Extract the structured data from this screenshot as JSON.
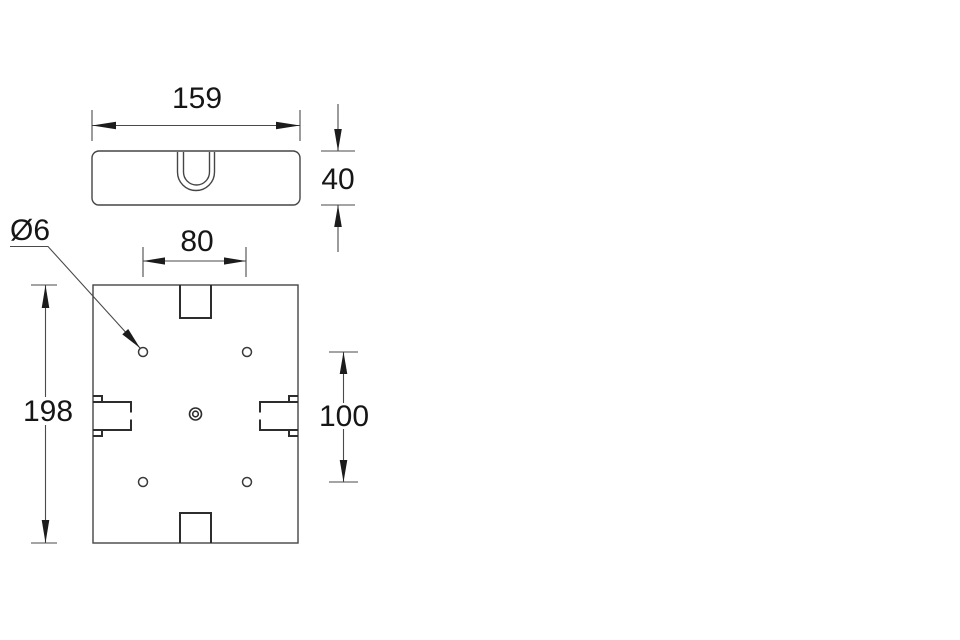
{
  "drawing": {
    "type": "technical-dimension-drawing",
    "background": "#ffffff",
    "line_color": "#454545",
    "feature_line_color": "#2d2d2d",
    "text_color": "#161616",
    "views": {
      "front_view": {
        "name": "front elevation with handle recess"
      },
      "plan_view": {
        "name": "plan view with mounting holes, notches and side clips"
      }
    },
    "dims": {
      "front_width": {
        "label": "159",
        "value": 159
      },
      "front_height": {
        "label": "40",
        "value": 40
      },
      "hole_span_x": {
        "label": "80",
        "value": 80
      },
      "hole_span_y": {
        "label": "100",
        "value": 100
      },
      "plan_height": {
        "label": "198",
        "value": 198
      },
      "hole_dia": {
        "label": "Ø6",
        "value": 6
      }
    }
  }
}
